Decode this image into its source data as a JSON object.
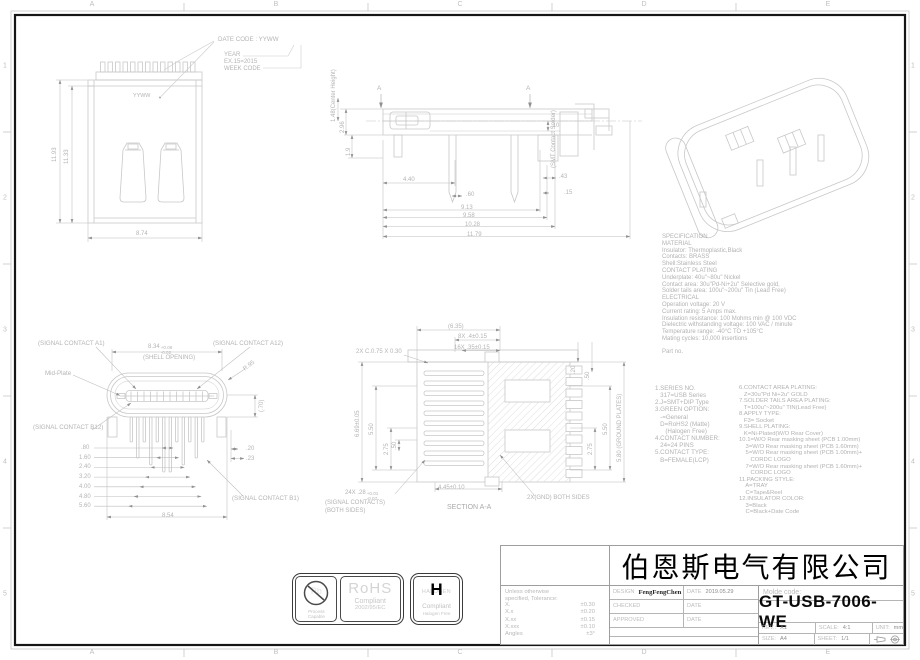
{
  "frame": {
    "zone_letters": [
      "A",
      "B",
      "C",
      "D",
      "E"
    ],
    "zone_numbers": [
      "1",
      "2",
      "3",
      "4",
      "5"
    ]
  },
  "date_code_note": {
    "line1": "DATE CODE : YYWW",
    "year_label": "YEAR",
    "year_example": "EX.15=2015",
    "week_label": "WEEK CODE"
  },
  "top_view": {
    "marking": "YYWW",
    "dim_height_outer": "11.93",
    "dim_height_inner": "11.33",
    "dim_width": "8.74"
  },
  "side_view": {
    "center_height": "1.48(Center Height)",
    "dim_296": "2.96",
    "dim_19": "1.9",
    "section_marker_left": "A",
    "section_marker_right": "A",
    "smt_label": "(SMT Contact Solder)",
    "dim_010": ".10",
    "dim_440": "4.40",
    "dim_060": ".60",
    "dim_043": ".43",
    "dim_015": ".15",
    "dim_913": "9.13",
    "dim_958": "9.58",
    "dim_1028": "10.28",
    "dim_1179": "11.79"
  },
  "face_view": {
    "label_a1": "(SIGNAL CONTACT A1)",
    "label_a12": "(SIGNAL CONTACT A12)",
    "label_b12": "(SIGNAL CONTACT B12)",
    "label_b1": "(SIGNAL CONTACT B1)",
    "label_midplate": "Mid-Plate",
    "shell_main": "8.34",
    "shell_tol_plus": "+0.06",
    "shell_tol_minus": "-0.02",
    "shell_caption": "(SHELL OPENING)",
    "dim_radius": "R.95",
    "dim_070": "(.70)",
    "pitch": [
      ".80",
      "1.60",
      "2.40",
      "3.20",
      "4.00",
      "4.80",
      "5.60"
    ],
    "dim_020": ".20",
    "dim_023": ".23",
    "dim_854": "8.54"
  },
  "section_view": {
    "chamfer": "2X C.0.75 X 0.30",
    "dim_635": "(6.35)",
    "dim_8x": "8X .4±0.15",
    "dim_16x": "16X .35±0.15",
    "dim_669": "6.69±0.05",
    "left_550": "5.50",
    "left_275": "2.75",
    "left_050": ".50",
    "right_020": ".20",
    "right_050": ".50",
    "right_550": "5.50",
    "right_275": "2.75",
    "right_580": "5.80 (GROUND PLATES)",
    "dim_445": "4.45±0.10",
    "c24_main": "24X .28",
    "c24_tol_plus": "+0.01",
    "c24_tol_minus": "-0.07",
    "c24_line2": "(SIGNAL CONTACTS)",
    "c24_line3": "(BOTH SIDES)",
    "gnd_label": "2X(GND) BOTH SIDES",
    "caption": "SECTION A-A"
  },
  "specification": {
    "lines": [
      "SPECIFICATION",
      "MATERIAL",
      "Insulator: Thermoplastic,Black",
      "Contacts: BRASS",
      "Shell:Stainless Steel",
      "CONTACT PLATING",
      "Underplate: 40u\"~80u\" Nickel",
      "Contact area: 30u\"Pd-Ni+2u\" Selective gold,",
      "Solder tails area: 100u\"~200u\" Tin (Lead Free)",
      "ELECTRICAL",
      "Operation voltage: 20 V",
      "Current rating: 5 Amps max.",
      "Insulation resistance: 100 Mohms min @ 100 VDC",
      "Dielectric withstanding voltage: 100 VAC / minute",
      "Temperature range: -40°C TO +105°C",
      "Mating cycles: 10,000 insertions"
    ],
    "part_no": "Part no."
  },
  "notes": {
    "left": [
      "1.SERIES NO.",
      "   317=USB Series",
      "2.J=SMT+DIP Type",
      "3.GREEN OPTION:",
      "   -=General",
      "   D=RoHS2 (Matte)",
      "      (Halogen Free)",
      "4.CONTACT NUMBER:",
      "   24=24 PINS",
      "5.CONTACT TYPE:",
      "   B=FEMALE(LCP)"
    ],
    "right": [
      "6.CONTACT AREA PLATING:",
      "   Z=30u\"Pd Ni+2u\" GOLD",
      "7.SOLDER TAILS AREA PLATING:",
      "   T=100u\"~200u\" TIN(Lead Free)",
      "8.APPLY TYPE:",
      "   F3= Socket",
      "9.SHELL PLATING:",
      "   K=Ni-Plated(W/O Rear Cover)",
      "10.1=W/O Rear masking sheet (PCB 1.00mm)",
      "    3=W/O Rear masking sheet (PCB 1.60mm)",
      "    5=W/O Rear masking sheet (PCB 1.00mm)+",
      "       CORDC LOGO",
      "    7=W/O Rear masking sheet (PCB 1.60mm)+",
      "       CORDC LOGO",
      "11.PACKING STYLE:",
      "    A=TRAY",
      "    C=Tape&Reel",
      "12.INSULATOR COLOR:",
      "    3=Black",
      "    C=Black+Date Code"
    ]
  },
  "logos": {
    "pb": {
      "symbol": "Pb",
      "caption1": "Process",
      "caption2": "Capable"
    },
    "rohs": {
      "title": "RoHS",
      "line1": "Compliant",
      "line2": "2002/95/EC"
    },
    "halogen": {
      "word": "HALOGEN",
      "big": "H",
      "line1": "Compliant",
      "line2": "Halogen Free"
    }
  },
  "title_block": {
    "company": "伯恩斯电气有限公司",
    "part_number": "GT-USB-7006-WE",
    "molde_label": "Molde code:",
    "tolerance": {
      "intro1": "Unless otherwise",
      "intro2": "specified, Tolerance:",
      "items": [
        {
          "k": "X.",
          "v": "±0.30"
        },
        {
          "k": "X.x",
          "v": "±0.20"
        },
        {
          "k": "X.xx",
          "v": "±0.15"
        },
        {
          "k": "X.xxx",
          "v": "±0.10"
        },
        {
          "k": "Angles",
          "v": "±3°"
        }
      ]
    },
    "rows": [
      {
        "label": "DESIGN",
        "value": "FengFengChen",
        "date_label": "DATE",
        "date_value": "2019.05.29"
      },
      {
        "label": "CHECKED",
        "value": "",
        "date_label": "DATE",
        "date_value": ""
      },
      {
        "label": "APPROVED",
        "value": "",
        "date_label": "DATE",
        "date_value": ""
      }
    ],
    "rev_label": "REV.:",
    "rev_value": "X1",
    "scale_label": "SCALE:",
    "scale_value": "4:1",
    "unit_label": "UNIT:",
    "unit_value": "mm",
    "size_label": "SIZE:",
    "size_value": "A4",
    "sheet_label": "SHEET:",
    "sheet_value": "1/1"
  }
}
